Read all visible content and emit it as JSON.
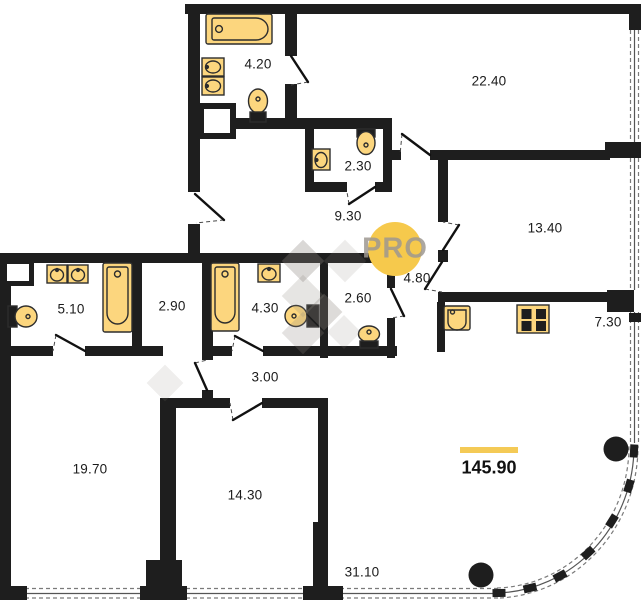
{
  "plan": {
    "watermark": "PRO",
    "total_area": "145.90",
    "rooms": {
      "bath_a": "4.20",
      "bedroom_a": "22.40",
      "wc_a": "2.30",
      "hall_a": "9.30",
      "bedroom_b": "13.40",
      "bath_b": "5.10",
      "wardrobe": "2.90",
      "bath_c": "4.30",
      "wc_b": "2.60",
      "hall_b": "4.80",
      "kitchen": "7.30",
      "hall_c": "3.00",
      "bedroom_c": "19.70",
      "bedroom_d": "14.30",
      "living": "31.10"
    },
    "colors": {
      "wall": "#1e1e1e",
      "fixture_fill": "#fcd67e",
      "fixture_stroke": "#2d2d2d",
      "accent_yellow": "#f4ca56",
      "badge_yellow": "#f6c94c",
      "watermark_grey": "#8d8781"
    },
    "icons": {
      "bathtub-icon": "rounded rect with inner basin and drain circle",
      "sink-icon": "rect with oval bowl and tap dot",
      "toilet-icon": "oval bowl with dark cistern",
      "stove-icon": "square with four burner squares",
      "kitchen-sink-icon": "rounded square basin with tap dot",
      "column-icon": "filled black circle",
      "window-icon": "dashed double line",
      "door-icon": "leaf line with dashed swing"
    }
  }
}
